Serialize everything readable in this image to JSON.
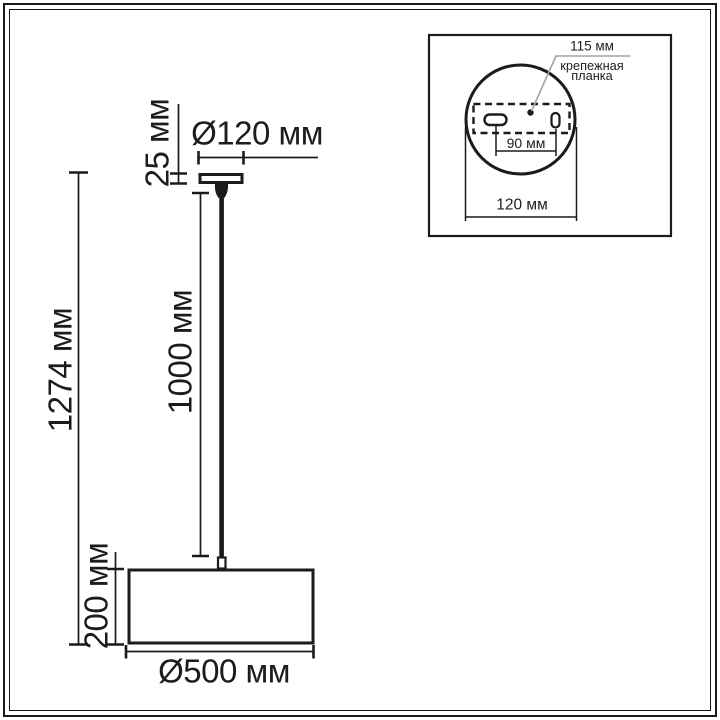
{
  "drawing": {
    "overall_height": "1274 мм",
    "canopy_height": "25 мм",
    "canopy_diameter": "Ø120 мм",
    "cord_length": "1000 мм",
    "shade_height": "200 мм",
    "shade_diameter": "Ø500 мм"
  },
  "inset": {
    "bracket_length": "115 мм",
    "bracket_name_line1": "крепежная",
    "bracket_name_line2": "планка",
    "hole_spacing": "90 мм",
    "plate_diameter": "120 мм"
  },
  "colors": {
    "line": "#1b1b1b",
    "leader": "#a3a3a3",
    "text": "#1c1c1c",
    "background": "#ffffff"
  }
}
